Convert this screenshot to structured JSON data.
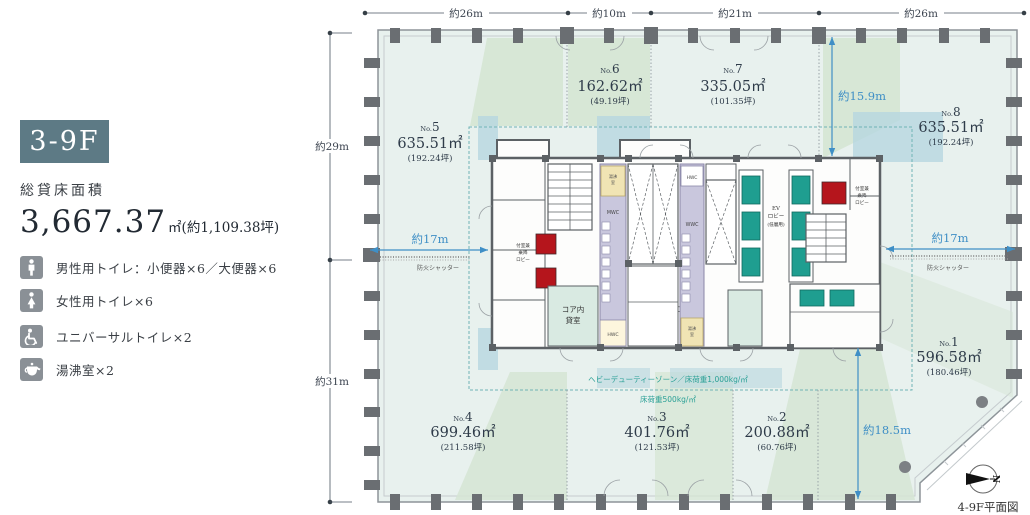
{
  "panel": {
    "floor_badge": "3-9F",
    "area_label": "総貸床面積",
    "area_value": "3,667.37",
    "area_unit": "㎡(約1,109.38坪)",
    "legend": [
      {
        "icon": "male-toilet-icon",
        "label": "男性用トイレ：小便器×6／大便器×6"
      },
      {
        "icon": "female-toilet-icon",
        "label": "女性用トイレ×6"
      },
      {
        "icon": "universal-toilet-icon",
        "label": "ユニバーサルトイレ×2"
      },
      {
        "icon": "kettle-icon",
        "label": "湯沸室×2"
      }
    ]
  },
  "dimensions": {
    "top": [
      "約26m",
      "約10m",
      "約21m",
      "約26m"
    ],
    "left_upper": "約29m",
    "left_lower": "約31m",
    "span_left": "約17m",
    "span_right": "約17m",
    "depth_upper_right": "約15.9m",
    "depth_lower_right": "約18.5m"
  },
  "rooms": [
    {
      "prefix": "No.",
      "number": "5",
      "area": "635.51㎡",
      "tsubo": "(192.24坪)"
    },
    {
      "prefix": "No.",
      "number": "6",
      "area": "162.62㎡",
      "tsubo": "(49.19坪)"
    },
    {
      "prefix": "No.",
      "number": "7",
      "area": "335.05㎡",
      "tsubo": "(101.35坪)"
    },
    {
      "prefix": "No.",
      "number": "8",
      "area": "635.51㎡",
      "tsubo": "(192.24坪)"
    },
    {
      "prefix": "No.",
      "number": "1",
      "area": "596.58㎡",
      "tsubo": "(180.46坪)"
    },
    {
      "prefix": "No.",
      "number": "2",
      "area": "200.88㎡",
      "tsubo": "(60.76坪)"
    },
    {
      "prefix": "No.",
      "number": "3",
      "area": "401.76㎡",
      "tsubo": "(121.53坪)"
    },
    {
      "prefix": "No.",
      "number": "4",
      "area": "699.46㎡",
      "tsubo": "(211.58坪)"
    }
  ],
  "core": {
    "fire_shutter": "防火シャッター",
    "tenant_line1": "コア内",
    "tenant_line2": "貸室",
    "vestibule_line1": "付室兼",
    "vestibule_line2": "乗降",
    "vestibule_line3": "ロビー",
    "ev_line1": "EV",
    "ev_line2": "ロビー",
    "ev_line3": "(低層用)",
    "mwc": "MWC",
    "wwc": "WWC",
    "hwc": "HWC",
    "kettle_line1": "湯沸",
    "kettle_line2": "室"
  },
  "zones": {
    "heavy_duty": "ヘビーデューティーゾーン／床荷重1,000kg/㎡",
    "floor_load": "床荷重500kg/㎡"
  },
  "footer": {
    "caption": "4-9F平面図",
    "compass_north": "N"
  }
}
